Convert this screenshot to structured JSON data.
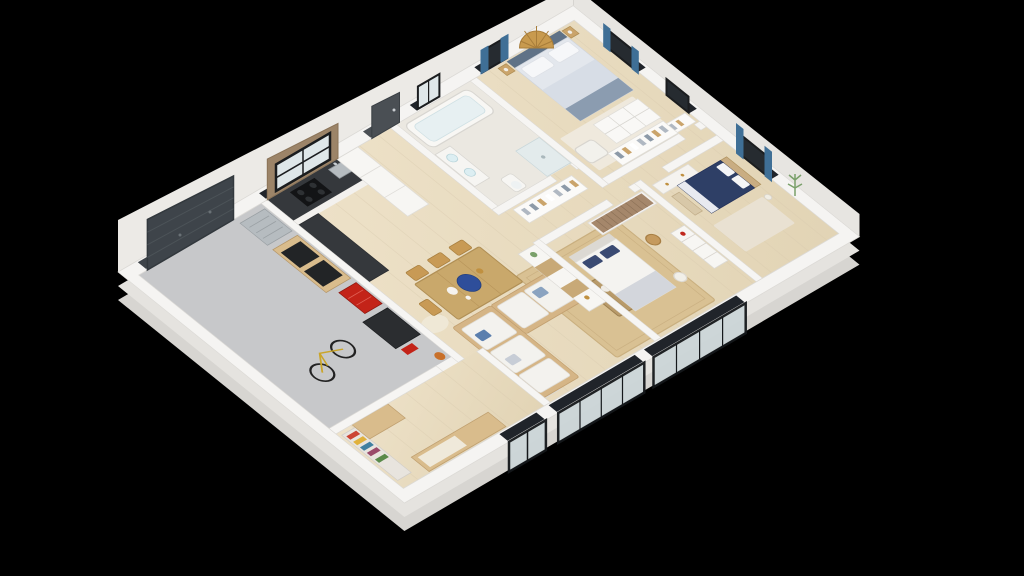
{
  "scene": {
    "type": "3d-isometric-floor-plan",
    "background": "#000000",
    "palette": {
      "wall_top": "#f5f4f2",
      "wall_face": "#eceae6",
      "wall_face_ne": "#e7e5e1",
      "wall_face_mid": "#e5e3df",
      "wall_face_dark": "#d7d5d1",
      "wall_stroke": "#dcdad6",
      "wood_floor_a": "#eee2c9",
      "wood_floor_b": "#e2d4b5",
      "plank_line": "#d9cbb0",
      "garage_floor": "#c7c8ca",
      "bathroom_floor": "#ebe8e1",
      "garage_door": "#3e444a",
      "garage_door_seam": "#4c5358",
      "entry_door": "#4a4f54",
      "window_glass": "#262b30",
      "window_glass_light": "#dfe7e9",
      "window_frame": "#1b1d1f",
      "curtain_blue": "#3f6f96",
      "glass_door_pane": "#ccd6d8",
      "counter_dark": "#35383c",
      "steel": "#b6bcc0",
      "cooktop_black": "#131416",
      "cabinet_white": "#f7f6f3",
      "red_tool": "#c32318",
      "dark_unit": "#2b2d30",
      "bench_wood": "#d9bc8c",
      "table_wood": "#c9a86b",
      "chair_gold": "#c89a55",
      "coffee_wood": "#b89a6a",
      "sofa_base": "#d5b586",
      "cushion_white": "#f3f2ee",
      "rug_living": "#d9c193",
      "rug_pale": "#e9e1d2",
      "rug_master": "#efe9dd",
      "platter_blue": "#2e4e9a",
      "navy_bed": "#2e3f66",
      "master_duvet": "#e3e7ed",
      "master_throw": "#8b9cb0",
      "headboard_slate": "#5f7287",
      "white_bed": "#f4f3f0",
      "pillow_navy": "#3a4a72",
      "wardrobe_wood": "#a5876b",
      "fan_gold": "#c89a4e",
      "plant_green": "#7aa06a",
      "tub_inner": "#e7f0f2",
      "basket_tan": "#c59a5e",
      "orange_bag": "#c8702a",
      "bike_frame": "#caa52a"
    },
    "rooms": [
      {
        "name": "garage",
        "floor": "concrete-gray",
        "items": [
          "garage-door",
          "bicycle",
          "steel-cart",
          "workbench",
          "red-tool-cabinet",
          "storage-unit",
          "orange-bag"
        ]
      },
      {
        "name": "entry-storage",
        "floor": "wood",
        "items": [
          "color-bookshelf",
          "wood-cabinet",
          "bench",
          "white-bookshelf"
        ]
      },
      {
        "name": "kitchen",
        "floor": "wood",
        "items": [
          "counter",
          "sink",
          "cooktop",
          "tall-cabinets",
          "window"
        ]
      },
      {
        "name": "dining-area",
        "floor": "wood",
        "items": [
          "dining-table",
          "seven-chairs",
          "blue-platter",
          "oval-rug"
        ]
      },
      {
        "name": "living-room",
        "floor": "wood",
        "items": [
          "corner-sofa",
          "coffee-table",
          "area-rug",
          "media-console",
          "white-bookshelf",
          "sliding-glass-doors"
        ]
      },
      {
        "name": "bathroom",
        "floor": "tile",
        "items": [
          "bathtub",
          "vanity",
          "toilet",
          "shower"
        ]
      },
      {
        "name": "master-bedroom",
        "floor": "wood",
        "items": [
          "double-bed",
          "fan-headboard-art",
          "nightstands",
          "armchair",
          "cubby-shelf",
          "closet",
          "window-blue-curtains"
        ]
      },
      {
        "name": "hallway",
        "floor": "wood",
        "items": [
          "open-closet-a",
          "open-closet-b"
        ]
      },
      {
        "name": "bedroom-2",
        "floor": "wood",
        "items": [
          "navy-bed",
          "foot-bench",
          "dresser",
          "rug",
          "window-blue-curtains",
          "plant-wall-decal"
        ]
      },
      {
        "name": "bedroom-3",
        "floor": "wood",
        "items": [
          "white-bed",
          "slat-wardrobe",
          "lattice-dresser",
          "floor-lamp",
          "rattan-basket"
        ]
      }
    ]
  }
}
